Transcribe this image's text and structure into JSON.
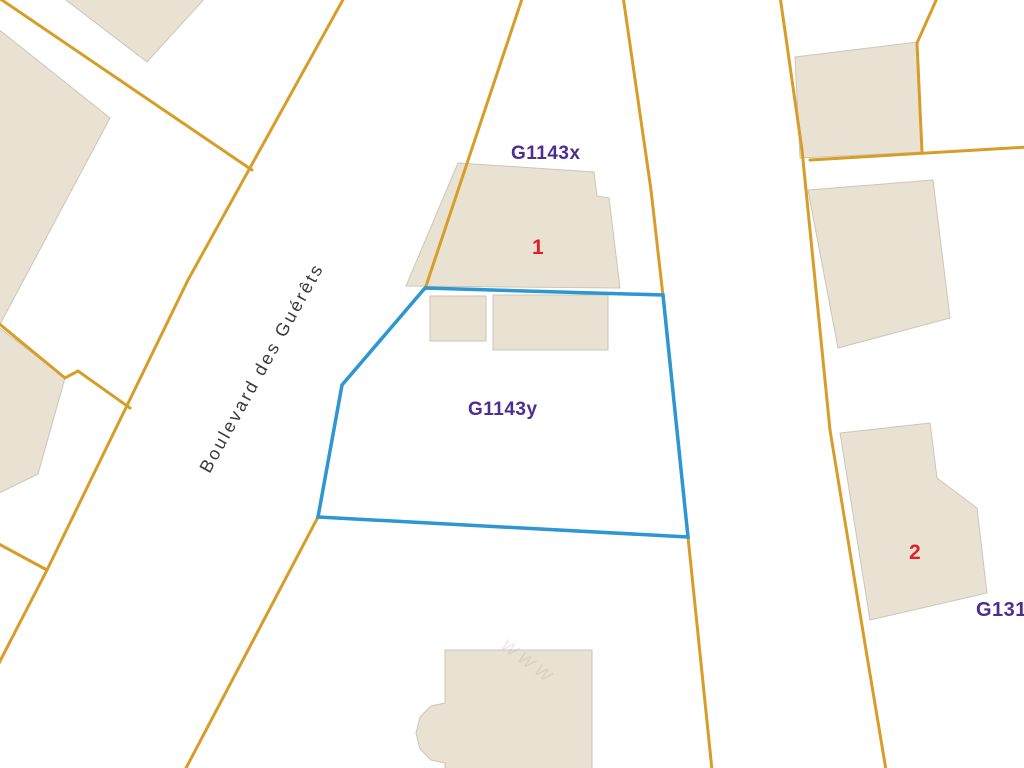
{
  "map": {
    "colors": {
      "background": "#ffffff",
      "parcel_line": "#d79d29",
      "building_fill": "#e9e2d3",
      "building_edge": "#ccc6b7",
      "selected_parcel_stroke": "#2e96d0",
      "label_purple": "#4f2d8f",
      "label_red": "#e01f26",
      "street_text": "#3a3a3a"
    },
    "labels": {
      "parcel_x": "G1143x",
      "parcel_y": "G1143y",
      "parcel_right": "G131",
      "building_1": "1",
      "building_2": "2",
      "street_name": "Boulevard des Guérêts",
      "watermark": "www"
    },
    "geometry": {
      "buildings": [
        {
          "name": "building-topleft-strip",
          "points": [
            [
              62,
              -3
            ],
            [
              206,
              -3
            ],
            [
              147,
              62
            ]
          ]
        },
        {
          "name": "building-left-upper",
          "points": [
            [
              -3,
              28
            ],
            [
              110,
              118
            ],
            [
              -3,
              330
            ]
          ]
        },
        {
          "name": "building-left-lower",
          "points": [
            [
              -3,
              326
            ],
            [
              65,
              378
            ],
            [
              38,
              474
            ],
            [
              -3,
              494
            ]
          ]
        },
        {
          "name": "building-1-footprint",
          "points": [
            [
              458,
              163
            ],
            [
              594,
              172
            ],
            [
              597,
              196
            ],
            [
              609,
              198
            ],
            [
              620,
              288
            ],
            [
              406,
              286
            ]
          ]
        },
        {
          "name": "building-small-square",
          "points": [
            [
              430,
              296
            ],
            [
              486,
              296
            ],
            [
              486,
              341
            ],
            [
              430,
              341
            ]
          ]
        },
        {
          "name": "building-small-rect",
          "points": [
            [
              493,
              295
            ],
            [
              608,
              295
            ],
            [
              608,
              350
            ],
            [
              493,
              350
            ]
          ]
        },
        {
          "name": "building-bottom",
          "points": [
            [
              445,
              650
            ],
            [
              592,
              650
            ],
            [
              592,
              770
            ],
            [
              445,
              770
            ],
            [
              445,
              763
            ],
            [
              431,
              760
            ],
            [
              420,
              749
            ],
            [
              416,
              733
            ],
            [
              420,
              717
            ],
            [
              431,
              706
            ],
            [
              445,
              703
            ]
          ]
        },
        {
          "name": "building-topright-upper",
          "points": [
            [
              795,
              57
            ],
            [
              917,
              42
            ],
            [
              922,
              152
            ],
            [
              800,
              158
            ]
          ]
        },
        {
          "name": "building-topright-lower",
          "points": [
            [
              808,
              190
            ],
            [
              933,
              180
            ],
            [
              950,
              318
            ],
            [
              838,
              348
            ]
          ]
        },
        {
          "name": "building-2-footprint",
          "points": [
            [
              840,
              433
            ],
            [
              930,
              423
            ],
            [
              937,
              478
            ],
            [
              977,
              508
            ],
            [
              987,
              593
            ],
            [
              870,
              620
            ]
          ]
        }
      ],
      "parcel_lines": [
        {
          "name": "parcel-line-topleft-diagonal",
          "points": [
            [
              -4,
              -4
            ],
            [
              252,
              170
            ]
          ]
        },
        {
          "name": "parcel-line-boulevard-west",
          "points": [
            [
              345,
              -4
            ],
            [
              188,
              280
            ],
            [
              47,
              570
            ],
            [
              -3,
              667
            ]
          ]
        },
        {
          "name": "parcel-line-left-step",
          "points": [
            [
              -3,
              322
            ],
            [
              65,
              378
            ],
            [
              78,
              371
            ],
            [
              130,
              408
            ]
          ]
        },
        {
          "name": "parcel-line-left-connector",
          "points": [
            [
              -3,
              543
            ],
            [
              47,
              570
            ]
          ]
        },
        {
          "name": "parcel-line-boulevard-east-upper",
          "points": [
            [
              523,
              -4
            ],
            [
              425,
              289
            ]
          ]
        },
        {
          "name": "parcel-line-boulevard-east-lower",
          "points": [
            [
              342,
              385
            ],
            [
              318,
              517
            ],
            [
              185,
              770
            ]
          ]
        },
        {
          "name": "parcel-line-center-vertical",
          "points": [
            [
              623,
              -4
            ],
            [
              651,
              190
            ],
            [
              663,
              296
            ],
            [
              688,
              537
            ],
            [
              712,
              770
            ]
          ]
        },
        {
          "name": "parcel-line-right-street",
          "points": [
            [
              780,
              -4
            ],
            [
              802,
              150
            ],
            [
              830,
              430
            ],
            [
              866,
              650
            ],
            [
              886,
              770
            ]
          ]
        },
        {
          "name": "parcel-line-right-horizontal",
          "points": [
            [
              810,
              160
            ],
            [
              1028,
              147
            ]
          ]
        },
        {
          "name": "parcel-line-topright-branch",
          "points": [
            [
              938,
              -4
            ],
            [
              917,
              43
            ],
            [
              922,
              152
            ]
          ]
        }
      ],
      "selected_parcel": {
        "name": "selected-parcel-g1143y",
        "points": [
          [
            425,
            288
          ],
          [
            663,
            295
          ],
          [
            688,
            537
          ],
          [
            318,
            517
          ],
          [
            342,
            385
          ]
        ]
      }
    }
  }
}
